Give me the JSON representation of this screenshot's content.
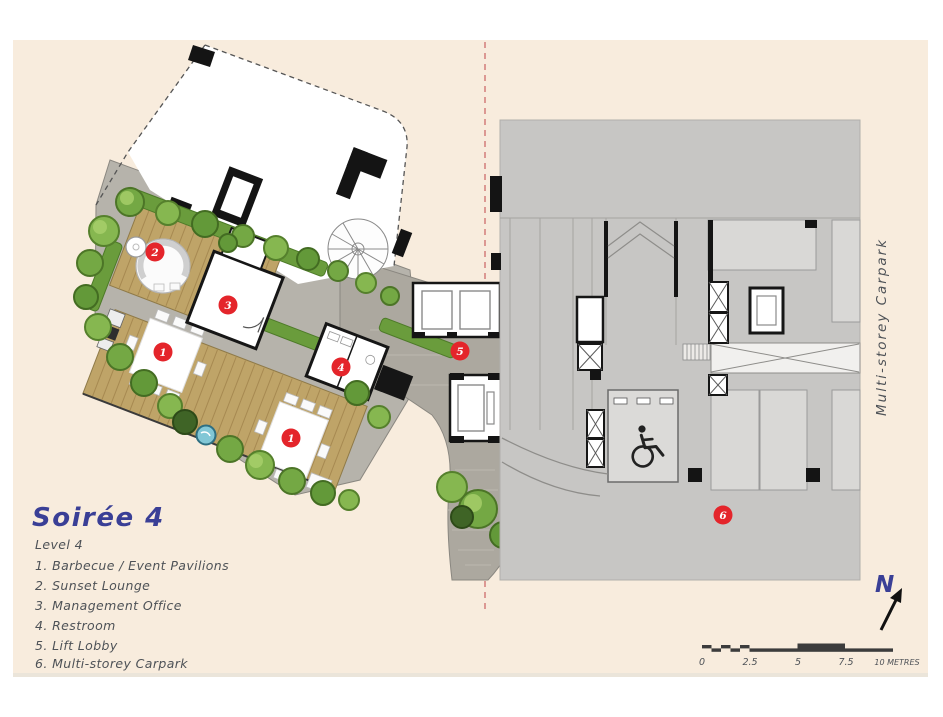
{
  "page": {
    "kind": "architectural site plan brochure page",
    "paper_color": "#f8ecdd",
    "accent_red": "#e4252b",
    "ink_blue": "#3a3f96",
    "ink_gray": "#4e5257"
  },
  "title": "Soirée 4",
  "legend": {
    "level": "Level 4",
    "items": [
      "1. Barbecue / Event Pavilions",
      "2. Sunset Lounge",
      "3. Management Office",
      "4. Restroom",
      "5. Lift Lobby",
      "6. Multi-storey Carpark"
    ]
  },
  "plan": {
    "markers": [
      {
        "num": "2",
        "label": "Sunset Lounge"
      },
      {
        "num": "3",
        "label": "Management Office"
      },
      {
        "num": "1",
        "label": "Barbecue / Event Pavilion"
      },
      {
        "num": "4",
        "label": "Restroom"
      },
      {
        "num": "1",
        "label": "Barbecue / Event Pavilion"
      },
      {
        "num": "5",
        "label": "Lift Lobby"
      },
      {
        "num": "6",
        "label": "Multi-storey Carpark"
      }
    ],
    "carpark_label": "Multi-storey Carpark",
    "north_label": "N"
  },
  "scale_bar": {
    "ticks": [
      "0",
      "2.5",
      "5",
      "7.5"
    ],
    "end_label": "10 METRES"
  }
}
